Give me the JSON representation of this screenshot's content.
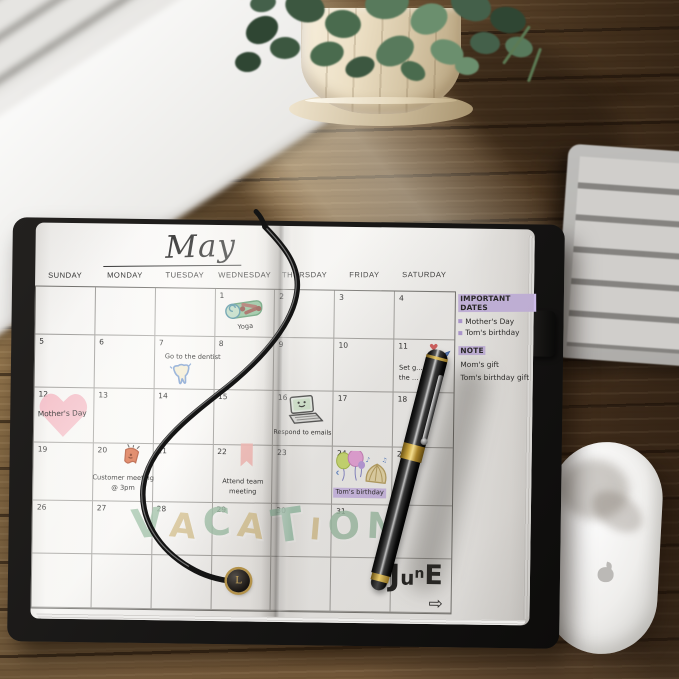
{
  "calendar": {
    "title": "May",
    "day_headers": [
      "SUNDAY",
      "MONDAY",
      "TUESDAY",
      "WEDNESDAY",
      "THURSDAY",
      "FRIDAY",
      "SATURDAY"
    ],
    "weeks": [
      [
        "",
        "",
        "",
        "1",
        "2",
        "3",
        "4"
      ],
      [
        "5",
        "6",
        "7",
        "8",
        "9",
        "10",
        "11"
      ],
      [
        "12",
        "13",
        "14",
        "15",
        "16",
        "17",
        "18"
      ],
      [
        "19",
        "20",
        "21",
        "22",
        "23",
        "24",
        "25"
      ],
      [
        "26",
        "27",
        "28",
        "29",
        "30",
        "31",
        ""
      ],
      [
        "",
        "",
        "",
        "",
        "",
        "",
        ""
      ]
    ],
    "events": [
      {
        "date": "1",
        "label": "Yoga",
        "icons": [
          "yoga-mat"
        ]
      },
      {
        "date": "7",
        "label": "Go to the dentist",
        "icons": [
          "tooth"
        ]
      },
      {
        "date": "11",
        "label": "Set g…\nthe …",
        "icons": [
          "heart-small",
          "pen-doodle"
        ]
      },
      {
        "date": "12",
        "label": "Mother's Day",
        "icons": [
          "heart-big"
        ]
      },
      {
        "date": "16",
        "label": "Respond to emails",
        "icons": [
          "laptop"
        ]
      },
      {
        "date": "20",
        "label": "Customer meeting\n@ 3pm",
        "icons": [
          "bell"
        ]
      },
      {
        "date": "22",
        "label": "Attend team\nmeeting",
        "icons": [
          "ribbon"
        ]
      },
      {
        "date": "24",
        "label": "Tom's birthday",
        "icons": [
          "balloons",
          "cake"
        ],
        "highlight": true
      }
    ],
    "vacation_letters": [
      {
        "char": "V",
        "color": "#9cc0a6"
      },
      {
        "char": "A",
        "color": "#d8c28c"
      },
      {
        "char": "C",
        "color": "#9cc0a6"
      },
      {
        "char": "A",
        "color": "#d8c28c"
      },
      {
        "char": "T",
        "color": "#94bfa6"
      },
      {
        "char": "I",
        "color": "#d8c28c"
      },
      {
        "char": "O",
        "color": "#9cc0a6"
      },
      {
        "char": "N",
        "color": "#9cc0a6"
      }
    ],
    "june_label": "JunE",
    "june_arrow": "⇨",
    "sidebar": {
      "important_title": "IMPORTANT DATES",
      "important_items": [
        "Mother's Day",
        "Tom's birthday"
      ],
      "note_title": "NOTE",
      "note_items": [
        "Mom's gift",
        "Tom's birthday gift"
      ],
      "highlight_color": "#cdbbe9"
    },
    "charm_letter": "L"
  },
  "colors": {
    "vacation_green": "#9cc0a6",
    "vacation_tan": "#d8c28c",
    "highlight_purple": "#cdbbe9",
    "heart_pink": "#f3b8c3",
    "pen_gold": "#caa53f",
    "desk_wood": "#7a5c3a"
  }
}
